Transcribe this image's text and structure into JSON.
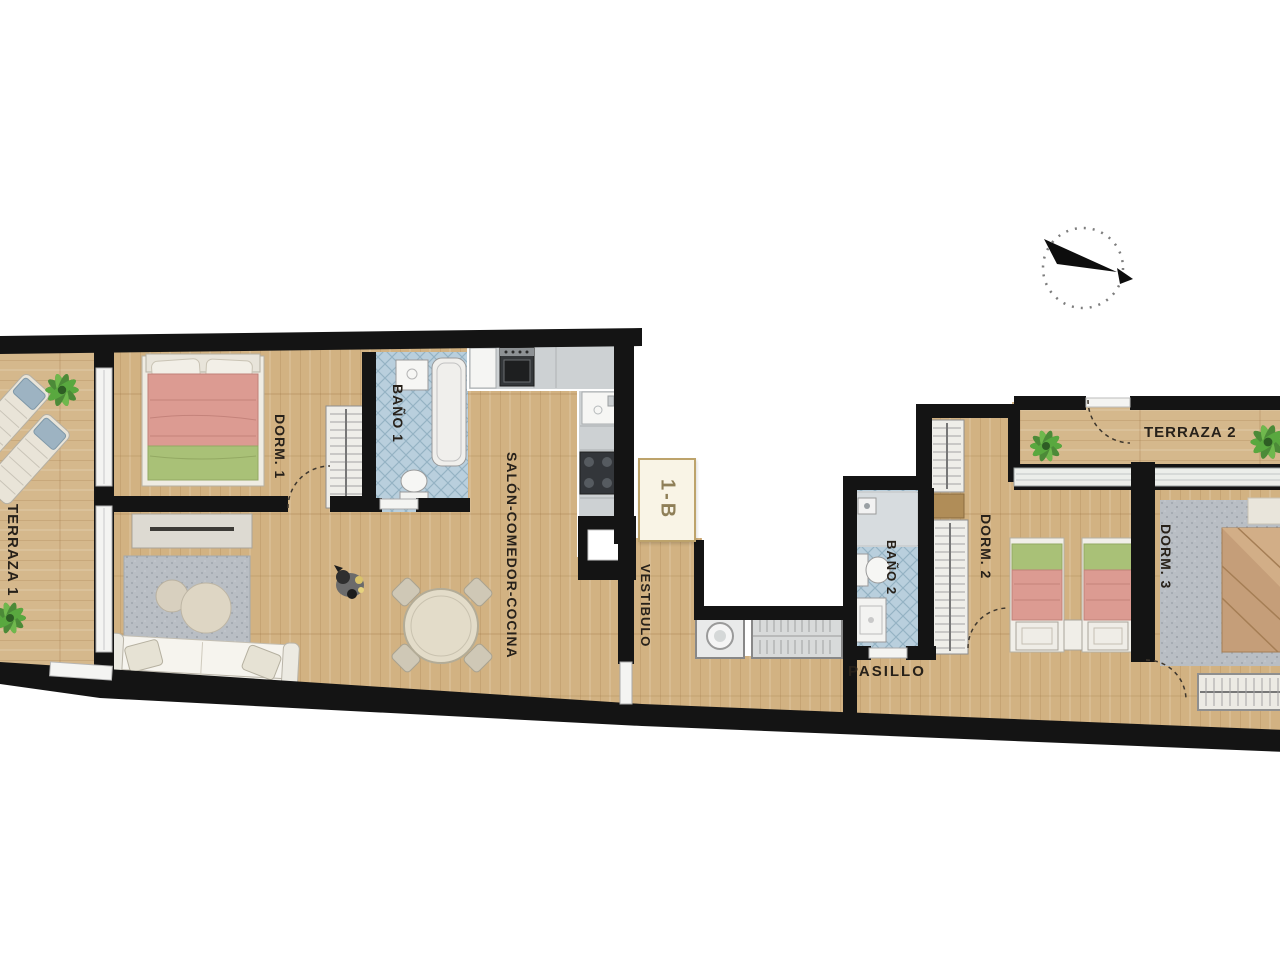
{
  "plan": {
    "title": "apartment-floor-plan",
    "unit_label": "1-B",
    "rooms": {
      "terraza1": "TERRAZA 1",
      "dorm1": "DORM. 1",
      "bano1": "BAÑO 1",
      "salon": "SALÓN-COMEDOR-COCINA",
      "vestibulo": "VESTIBULO",
      "pasillo": "PASILLO",
      "bano2": "BAÑO 2",
      "dorm2": "DORM. 2",
      "dorm3": "DORM. 3",
      "terraza2": "TERRAZA 2"
    },
    "furniture": {
      "terraza1": [
        "sun-lounger",
        "sun-lounger",
        "plant",
        "plant"
      ],
      "dorm1": [
        "double-bed",
        "wardrobe"
      ],
      "bano1": [
        "bathtub",
        "sink",
        "toilet"
      ],
      "salon": [
        "tv-console",
        "rug",
        "pouf",
        "pouf",
        "sofa",
        "dog",
        "dining-table",
        "chairs"
      ],
      "kitchen": [
        "fridge",
        "oven",
        "counter",
        "sink",
        "hob"
      ],
      "vestibulo": [
        "washing-machine",
        "shelf-unit"
      ],
      "bano2": [
        "shower",
        "toilet",
        "sink"
      ],
      "dorm2": [
        "twin-bed",
        "twin-bed",
        "nightstand",
        "wardrobe",
        "wardrobe"
      ],
      "dorm3": [
        "double-bed",
        "rug",
        "wardrobe"
      ],
      "terraza2": [
        "plant",
        "plant"
      ]
    },
    "compass": "north-arrow-compass-icon",
    "colors": {
      "wall": "#141414",
      "wood": "#d2b282",
      "wood_line": "#c09e6e",
      "tile": "#b9cfdd",
      "tile_line": "#94b2c4",
      "counter": "#cdd1d3",
      "rug": "#b9bec4",
      "bed_pink": "#dc9b92",
      "bed_green": "#a9c177",
      "bed_tan": "#c59e79",
      "plant_green": "#4c8a38",
      "badge_bg": "#f9f4e6",
      "badge_border": "#bda36b",
      "badge_text": "#8f7f58"
    }
  }
}
